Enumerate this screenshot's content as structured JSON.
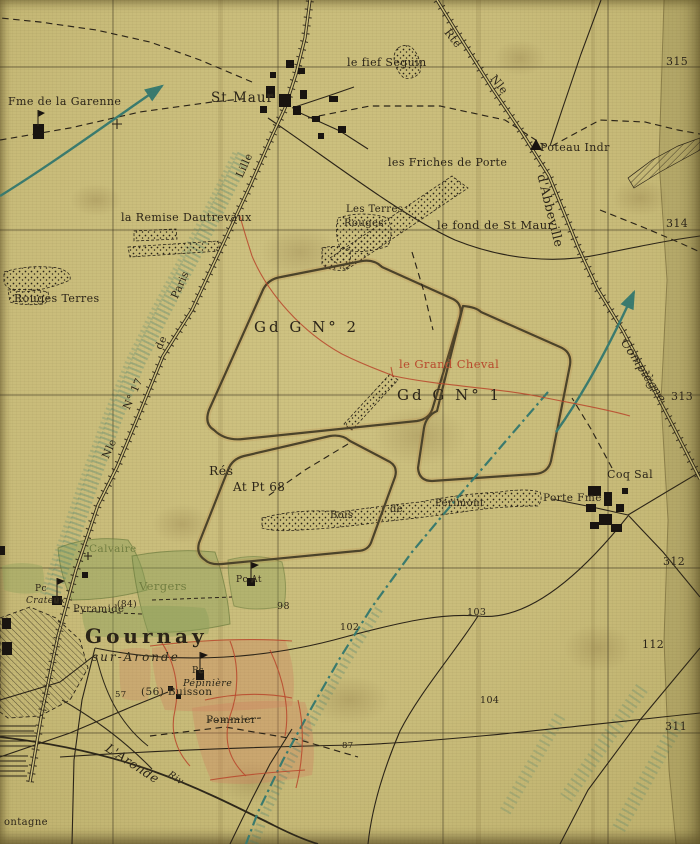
{
  "colors": {
    "paper": "#c9bc7a",
    "ink": "#2b2418",
    "red": "#b8492e",
    "teal": "#3a7a6e",
    "green": "#6f7d40",
    "building": "#191410"
  },
  "labels": [
    {
      "name": "fme-garenne",
      "text": "Fme de la Garenne",
      "x": 8,
      "y": 96,
      "size": 11
    },
    {
      "name": "st-maur",
      "text": "St Maur",
      "x": 211,
      "y": 92,
      "size": 13.5,
      "spacing": 1
    },
    {
      "name": "fief-seguin",
      "text": "le fief Seguin",
      "x": 347,
      "y": 57,
      "size": 11
    },
    {
      "name": "rte",
      "text": "Rte",
      "x": 451,
      "y": 27,
      "size": 11,
      "rot": 52
    },
    {
      "name": "nle-abbeville",
      "text": "Nle",
      "x": 497,
      "y": 73,
      "size": 11,
      "rot": 52
    },
    {
      "name": "poteau-indicateur",
      "text": "Poteau Indr",
      "x": 540,
      "y": 142,
      "size": 11
    },
    {
      "name": "dabbeville",
      "text": "d'Abbeville",
      "x": 547,
      "y": 173,
      "size": 12.5,
      "rot": 76
    },
    {
      "name": "grid-315",
      "text": "315",
      "x": 666,
      "y": 56,
      "size": 11
    },
    {
      "name": "friches-de-porte",
      "text": "les Friches de Porte",
      "x": 388,
      "y": 157,
      "size": 11
    },
    {
      "name": "les-terres",
      "text": "Les Terres",
      "x": 346,
      "y": 205,
      "size": 10
    },
    {
      "name": "terres-rouges",
      "text": "Rouges",
      "x": 344,
      "y": 219,
      "size": 10
    },
    {
      "name": "fond-st-maur",
      "text": "le fond de St Maur",
      "x": 437,
      "y": 220,
      "size": 11.5
    },
    {
      "name": "remise-dautrevaux",
      "text": "la Remise Dautrevaux",
      "x": 121,
      "y": 212,
      "size": 11
    },
    {
      "name": "rouges-terres",
      "text": "Rouges Terres",
      "x": 14,
      "y": 293,
      "size": 11
    },
    {
      "name": "grid-314",
      "text": "314",
      "x": 666,
      "y": 218,
      "size": 11
    },
    {
      "name": "ggn2",
      "text": "Gd G N° 2",
      "x": 254,
      "y": 320,
      "size": 15,
      "spacing": 3
    },
    {
      "name": "grand-cheval",
      "text": "le Grand Cheval",
      "x": 399,
      "y": 359,
      "size": 11.5,
      "color": "red"
    },
    {
      "name": "ggn1",
      "text": "Gd G N° 1",
      "x": 397,
      "y": 388,
      "size": 15,
      "spacing": 3
    },
    {
      "name": "compiegne",
      "text": "Compiègne",
      "x": 629,
      "y": 337,
      "size": 12,
      "rot": 57,
      "italic": true
    },
    {
      "name": "grid-313",
      "text": "313",
      "x": 671,
      "y": 391,
      "size": 11
    },
    {
      "name": "res",
      "text": "Rés",
      "x": 209,
      "y": 465,
      "size": 12.5
    },
    {
      "name": "at-pt-68",
      "text": "At Pt 68",
      "x": 233,
      "y": 481,
      "size": 12
    },
    {
      "name": "bois",
      "text": "Bois",
      "x": 330,
      "y": 511,
      "size": 10
    },
    {
      "name": "bois-de",
      "text": "de",
      "x": 390,
      "y": 505,
      "size": 10
    },
    {
      "name": "perimont",
      "text": "Perimont",
      "x": 435,
      "y": 499,
      "size": 10
    },
    {
      "name": "porte-fme",
      "text": "Porte Fme",
      "x": 543,
      "y": 493,
      "size": 10.5
    },
    {
      "name": "coq-sal",
      "text": "Coq Sal",
      "x": 607,
      "y": 469,
      "size": 11
    },
    {
      "name": "grid-312",
      "text": "312",
      "x": 663,
      "y": 556,
      "size": 11
    },
    {
      "name": "field-112",
      "text": "112",
      "x": 642,
      "y": 639,
      "size": 11
    },
    {
      "name": "grid-311",
      "text": "311",
      "x": 665,
      "y": 721,
      "size": 11
    },
    {
      "name": "calvaire",
      "text": "Calvaire",
      "x": 89,
      "y": 544,
      "size": 10.5,
      "color": "green"
    },
    {
      "name": "vergers",
      "text": "Vergers",
      "x": 139,
      "y": 581,
      "size": 11.5,
      "color": "green"
    },
    {
      "name": "pc-crateux",
      "text": "Pc",
      "x": 35,
      "y": 585,
      "size": 9
    },
    {
      "name": "crateux",
      "text": "Crateux",
      "x": 26,
      "y": 597,
      "size": 9,
      "italic": true
    },
    {
      "name": "pc-at",
      "text": "Pc At",
      "x": 236,
      "y": 576,
      "size": 9
    },
    {
      "name": "pyramide",
      "text": "Pyramide",
      "x": 73,
      "y": 605,
      "size": 10
    },
    {
      "name": "field-84",
      "text": "(84)",
      "x": 117,
      "y": 601,
      "size": 9
    },
    {
      "name": "gournay",
      "text": "Gournay",
      "x": 85,
      "y": 626,
      "size": 20,
      "bold": true,
      "spacing": 4
    },
    {
      "name": "sur-aronde",
      "text": "sur-Aronde",
      "x": 92,
      "y": 651,
      "size": 12,
      "italic": true,
      "spacing": 2
    },
    {
      "name": "pc-pepiniere",
      "text": "Pc",
      "x": 192,
      "y": 667,
      "size": 9
    },
    {
      "name": "pepiniere",
      "text": "Pépinière",
      "x": 183,
      "y": 679,
      "size": 9.5,
      "italic": true
    },
    {
      "name": "buisson",
      "text": "(56) Buisson",
      "x": 141,
      "y": 687,
      "size": 10.5
    },
    {
      "name": "field-57",
      "text": "57",
      "x": 115,
      "y": 691,
      "size": 8.5
    },
    {
      "name": "pommier",
      "text": "Pommier",
      "x": 206,
      "y": 715,
      "size": 10.5
    },
    {
      "name": "laronde",
      "text": "L'Aronde",
      "x": 110,
      "y": 742,
      "size": 12.5,
      "rot": 33,
      "italic": true
    },
    {
      "name": "riv",
      "text": "Riv",
      "x": 171,
      "y": 770,
      "size": 9.5,
      "rot": 33,
      "italic": true
    },
    {
      "name": "field-87",
      "text": "87",
      "x": 342,
      "y": 742,
      "size": 8.5
    },
    {
      "name": "field-102",
      "text": "102",
      "x": 340,
      "y": 623,
      "size": 9.5
    },
    {
      "name": "field-103",
      "text": "103",
      "x": 467,
      "y": 608,
      "size": 9.5
    },
    {
      "name": "field-104",
      "text": "104",
      "x": 480,
      "y": 696,
      "size": 9.5
    },
    {
      "name": "field-98",
      "text": "98",
      "x": 277,
      "y": 602,
      "size": 9.5
    },
    {
      "name": "montagne",
      "text": "ontagne",
      "x": 4,
      "y": 818,
      "size": 10
    },
    {
      "name": "lille",
      "text": "Lille",
      "x": 235,
      "y": 175,
      "size": 10.5,
      "rot": -66
    },
    {
      "name": "nle-paris",
      "text": "Nle",
      "x": 101,
      "y": 456,
      "size": 10.5,
      "rot": -66
    },
    {
      "name": "n17",
      "text": "N° 17",
      "x": 122,
      "y": 407,
      "size": 10.5,
      "rot": -66
    },
    {
      "name": "de-paris",
      "text": "de",
      "x": 154,
      "y": 347,
      "size": 10.5,
      "rot": -66
    },
    {
      "name": "paris",
      "text": "Paris",
      "x": 170,
      "y": 296,
      "size": 10.5,
      "rot": -66
    }
  ]
}
